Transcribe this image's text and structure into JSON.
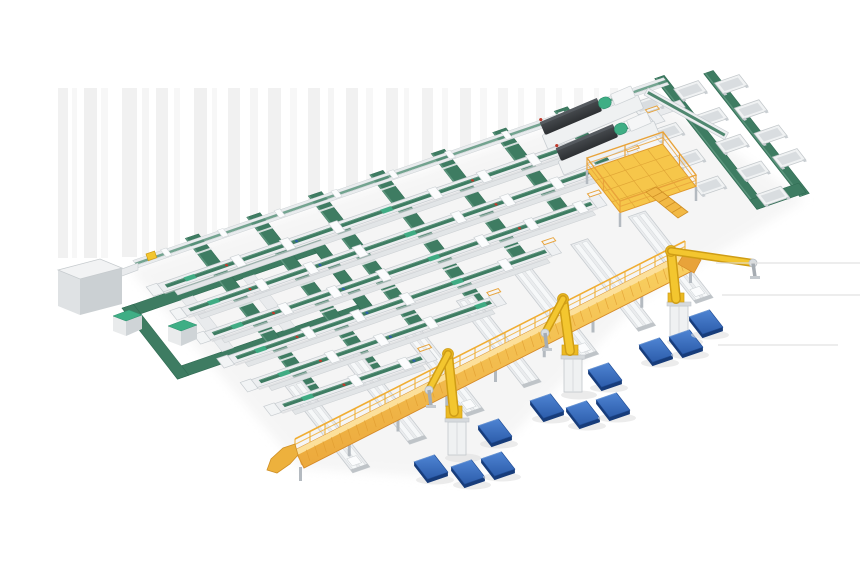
{
  "meta": {
    "description": "Isometric 3D render of an automated parcel sorting warehouse: green belt sorter lines, yellow picking gantry with robot arms, blue pallet stations, scanner machines, mezzanine platform and discharge chutes",
    "canvas_width": 860,
    "canvas_height": 580
  },
  "palette": {
    "background": "#ffffff",
    "streak": "#e3e3e3",
    "ground_shadow": "#ececec",
    "rail_white": "#eceef0",
    "rail_stroke": "#c7ccd0",
    "rail_shade": "#dfe3e6",
    "belt_green": "#3e7c62",
    "belt_green_dark": "#2f6a52",
    "belt_green_light": "#5b947c",
    "accent_teal": "#3fae85",
    "gantry_yellow": "#f7c84a",
    "gantry_yellow_light": "#fce09b",
    "gantry_orange": "#e8a33a",
    "gantry_deep": "#d68a28",
    "robot_yellow": "#f3c62f",
    "robot_yellow_dark": "#cf9d16",
    "pallet_blue": "#3a6fc0",
    "pallet_blue_dark": "#1d4a94",
    "pallet_blue_deep": "#173c7a",
    "machine_dark": "#4a4e52",
    "machine_darker": "#2d3033",
    "metal_gray": "#b4bac0",
    "accent_red": "#c0392b",
    "accent_blue": "#2e5fa8"
  },
  "floor_matrix": [
    0.946,
    -0.326,
    0.616,
    0.788,
    140,
    262
  ],
  "background": {
    "streak_top": 88,
    "streaks": [
      [
        58,
        10,
        258,
        0.5
      ],
      [
        72,
        5,
        258,
        0.3
      ],
      [
        84,
        13,
        258,
        0.55
      ],
      [
        101,
        7,
        258,
        0.3
      ],
      [
        122,
        15,
        257,
        0.5
      ],
      [
        142,
        7,
        256,
        0.35
      ],
      [
        156,
        12,
        252,
        0.5
      ],
      [
        174,
        6,
        247,
        0.3
      ],
      [
        194,
        13,
        240,
        0.55
      ],
      [
        212,
        5,
        235,
        0.3
      ],
      [
        228,
        12,
        229,
        0.5
      ],
      [
        250,
        8,
        223,
        0.35
      ],
      [
        268,
        13,
        217,
        0.5
      ],
      [
        290,
        7,
        210,
        0.3
      ],
      [
        308,
        12,
        204,
        0.5
      ],
      [
        328,
        6,
        198,
        0.35
      ],
      [
        346,
        12,
        191,
        0.5
      ],
      [
        366,
        7,
        185,
        0.3
      ],
      [
        386,
        12,
        178,
        0.45
      ],
      [
        404,
        5,
        172,
        0.3
      ],
      [
        422,
        11,
        166,
        0.45
      ],
      [
        442,
        6,
        160,
        0.3
      ],
      [
        460,
        11,
        153,
        0.45
      ],
      [
        480,
        7,
        147,
        0.3
      ],
      [
        498,
        10,
        141,
        0.4
      ],
      [
        518,
        6,
        134,
        0.3
      ],
      [
        536,
        9,
        128,
        0.4
      ],
      [
        556,
        6,
        122,
        0.3
      ],
      [
        574,
        9,
        115,
        0.35
      ],
      [
        594,
        5,
        109,
        0.3
      ],
      [
        610,
        8,
        103,
        0.35
      ],
      [
        628,
        5,
        97,
        0.3
      ]
    ],
    "side_streaks": [
      [
        716,
        263,
        144
      ],
      [
        722,
        295,
        138
      ],
      [
        718,
        345,
        120
      ]
    ],
    "ground_shadow_points": "130,270 650,95 805,200 640,300 470,480 300,468"
  },
  "loop_ring": {
    "u0": -45,
    "u1": 165,
    "v0": 40,
    "v1": 130,
    "bar": 12,
    "inner_bars": [
      10,
      75
    ]
  },
  "sorter_lines": [
    {
      "v": -4,
      "u0": -5,
      "u1": 556,
      "perimeter": true
    },
    {
      "v": 28,
      "u0": 0,
      "u1": 519
    },
    {
      "v": 60,
      "u0": 4,
      "u1": 477
    },
    {
      "v": 92,
      "u0": 8,
      "u1": 416
    },
    {
      "v": 124,
      "u0": 12,
      "u1": 347
    },
    {
      "v": 156,
      "u0": 16,
      "u1": 268
    },
    {
      "v": 188,
      "u0": 20,
      "u1": 174
    }
  ],
  "cross_bands": [
    [
      60,
      -8,
      196
    ],
    [
      125,
      -8,
      196
    ],
    [
      190,
      -8,
      164
    ],
    [
      255,
      -8,
      164
    ],
    [
      320,
      -8,
      132
    ],
    [
      385,
      -8,
      100
    ],
    [
      450,
      -8,
      68
    ]
  ],
  "spurs": [
    [
      49,
      174,
      284
    ],
    [
      115,
      165,
      275
    ],
    [
      181,
      157,
      267
    ],
    [
      247,
      148,
      258
    ],
    [
      313,
      140,
      250
    ],
    [
      379,
      131,
      241
    ],
    [
      445,
      123,
      233
    ]
  ],
  "chute_bank": {
    "green_lines": [
      [
        548,
        -6,
        10,
        166
      ],
      [
        592,
        6,
        10,
        156
      ]
    ],
    "u_turn": [
      548,
      148,
      52,
      12
    ],
    "feed": [
      519,
      24,
      36,
      9
    ],
    "trough_cols": [
      {
        "u": 524,
        "v": [
          18,
          52,
          86,
          120
        ]
      },
      {
        "u": 570,
        "v": [
          18,
          52,
          86,
          120,
          152
        ]
      },
      {
        "u": 608,
        "v": [
          26,
          58,
          90,
          120
        ]
      }
    ]
  },
  "corner_walkway": {
    "x": 648,
    "y": 88,
    "len": 92,
    "angle": 29
  },
  "mezzanine": {
    "plan": [
      432,
      62,
      80,
      54
    ],
    "rail_corners": [
      [
        587,
        170
      ],
      [
        663,
        144
      ],
      [
        696,
        187
      ],
      [
        620,
        213
      ]
    ],
    "legs": [
      [
        620,
        213
      ],
      [
        696,
        187
      ],
      [
        587,
        170
      ]
    ],
    "stairs": "646,192 656,187 688,212 678,218"
  },
  "machines": {
    "white_box": {
      "top": "58,270 100,259 122,268 80,279",
      "front": "58,270 58,306 80,315 80,279",
      "side": "80,279 80,315 122,304 122,268"
    },
    "connector": "114,272 138,263 138,270 114,279",
    "green_top_boxes": [
      [
        113,
        310
      ],
      [
        168,
        320
      ]
    ],
    "yellow_box": [
      146,
      254
    ],
    "dws_units": [
      [
        544,
        140
      ],
      [
        560,
        166
      ]
    ],
    "dws_angle": -23
  },
  "gantry": {
    "p1": [
      295,
      450
    ],
    "p2": [
      685,
      252
    ],
    "depth": 18,
    "ramp": "295,444 283,448 271,459 267,470 277,473 290,464 298,455",
    "end_cap": "685,252 701,260 694,273 678,264"
  },
  "robots": [
    {
      "base": [
        457,
        455
      ],
      "shoulder": [
        454,
        412
      ],
      "elbow": [
        448,
        354
      ],
      "wrist": [
        429,
        390
      ],
      "tip": [
        431,
        406
      ]
    },
    {
      "base": [
        573,
        392
      ],
      "shoulder": [
        570,
        351
      ],
      "elbow": [
        563,
        299
      ],
      "wrist": [
        545,
        333
      ],
      "tip": [
        547,
        349
      ]
    },
    {
      "base": [
        679,
        339
      ],
      "shoulder": [
        676,
        299
      ],
      "elbow": [
        671,
        251
      ],
      "wrist": [
        753,
        263
      ],
      "tip": [
        755,
        277
      ]
    }
  ],
  "pallets": [
    [
      431,
      467
    ],
    [
      468,
      472
    ],
    [
      498,
      464
    ],
    [
      495,
      431
    ],
    [
      547,
      406
    ],
    [
      583,
      413
    ],
    [
      613,
      405
    ],
    [
      605,
      375
    ],
    [
      656,
      350
    ],
    [
      686,
      342
    ],
    [
      706,
      322
    ]
  ]
}
